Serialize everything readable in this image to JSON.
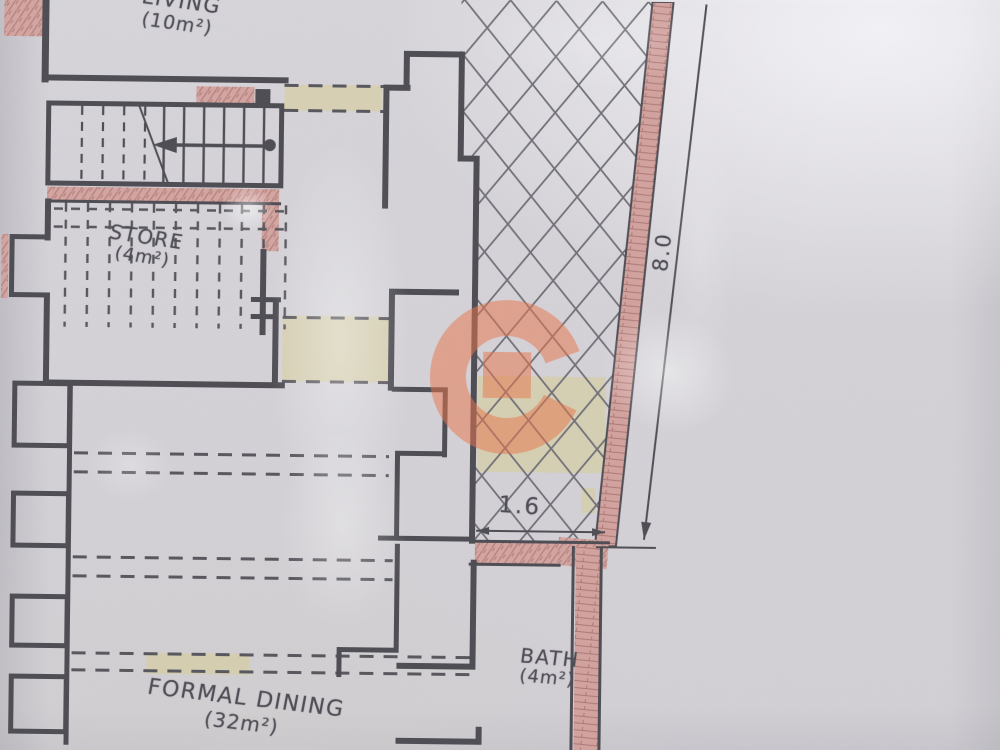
{
  "document": {
    "kind": "architectural floor plan (photographed)"
  },
  "rooms": {
    "living": {
      "name": "LIVING",
      "area": "(10m²)"
    },
    "store": {
      "name": "STORE",
      "area": "(4m²)"
    },
    "dining": {
      "name": "FORMAL DINING",
      "area": "(32m²)"
    },
    "bath": {
      "name": "BATH",
      "area": "(4m²)"
    }
  },
  "dimensions": {
    "terrace_edge": "8.0",
    "opening": "1.6"
  },
  "watermark": {
    "letter": "G",
    "color": "#e8744a"
  },
  "colors": {
    "paper": "#d4d2d7",
    "ink": "#4b4a51",
    "masonry_fill": "#d1a19d",
    "highlight": "#d6cd9b"
  }
}
